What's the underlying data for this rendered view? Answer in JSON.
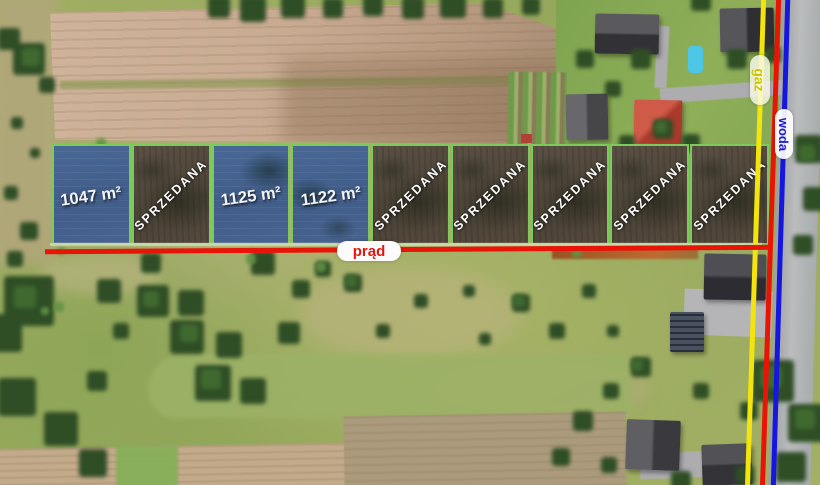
{
  "plots": [
    {
      "label": "1047 m²",
      "status": "available"
    },
    {
      "label": "SPRZEDANA",
      "status": "sold"
    },
    {
      "label": "1125 m²",
      "status": "available"
    },
    {
      "label": "1122 m²",
      "status": "available"
    },
    {
      "label": "SPRZEDANA",
      "status": "sold"
    },
    {
      "label": "SPRZEDANA",
      "status": "sold"
    },
    {
      "label": "SPRZEDANA",
      "status": "sold"
    },
    {
      "label": "SPRZEDANA",
      "status": "sold"
    },
    {
      "label": "SPRZEDANA",
      "status": "sold"
    }
  ],
  "utilities": {
    "power": {
      "label": "prąd",
      "color": "#e81408"
    },
    "gas": {
      "label": "gaz",
      "color": "#f2e40c"
    },
    "water": {
      "label": "woda",
      "color": "#1617dc"
    }
  },
  "overlay": {
    "available_fill": "#45628e",
    "sold_fill": "#4f4539",
    "plot_border": "#7cc95c",
    "label_color": "#ffffff"
  }
}
